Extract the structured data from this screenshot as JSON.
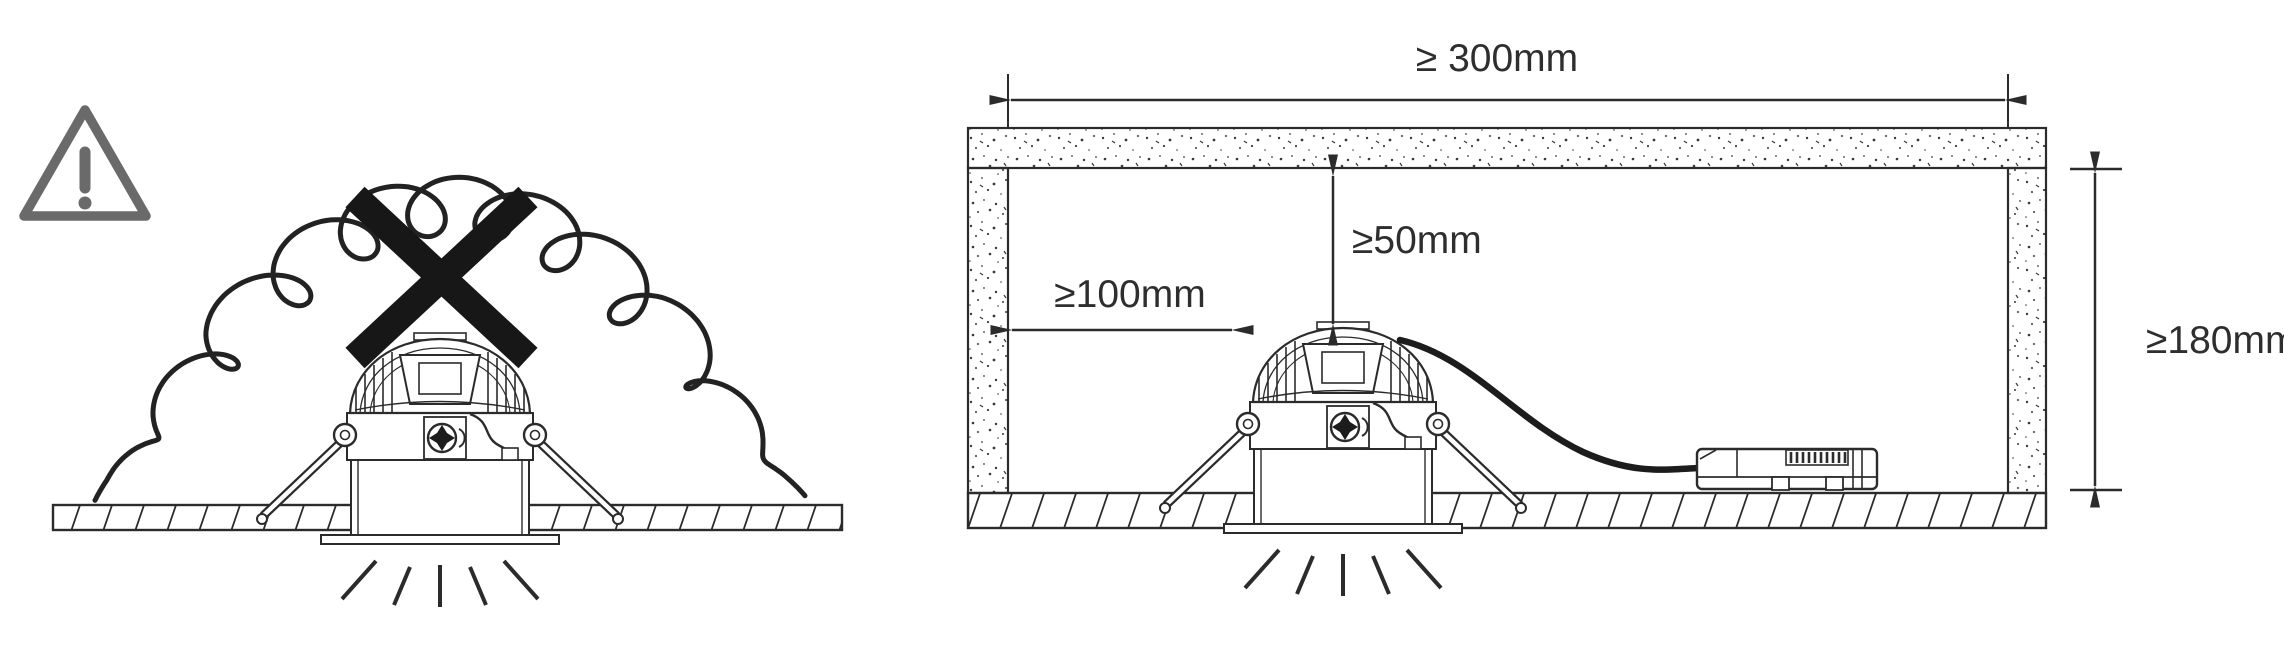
{
  "colors": {
    "ink": "#2b2b2b",
    "warning_gray": "#6a6a6a",
    "prohibition_black": "#171717",
    "background": "#ffffff"
  },
  "left_panel": {
    "meaning": "do-not-cover-luminaire-with-insulation",
    "icons": {
      "warning": "warning-triangle-icon",
      "prohibition": "prohibition-cross-icon",
      "insulation": "insulation-batt-icon",
      "luminaire": "recessed-downlight",
      "ceiling": "ceiling-section",
      "light": "light-rays-icon"
    }
  },
  "right_panel": {
    "meaning": "minimum-installation-clearances",
    "icons": {
      "enclosure": "joist-enclosure",
      "luminaire": "recessed-downlight",
      "driver": "led-driver",
      "cable": "driver-cable",
      "ceiling": "ceiling-section",
      "light": "light-rays-icon"
    },
    "dimensions": {
      "clearance_width": "≥ 300mm",
      "clearance_above": "≥50mm",
      "clearance_side": "≥100mm",
      "clearance_height": "≥180mm"
    }
  }
}
